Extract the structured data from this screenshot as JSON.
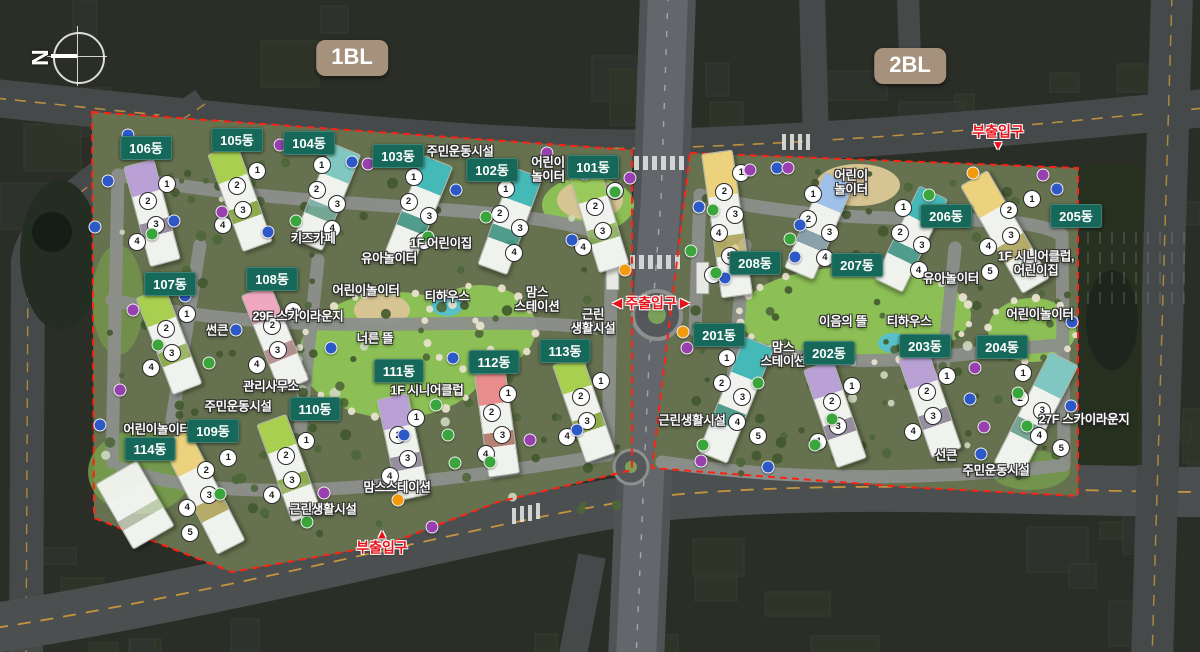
{
  "map": {
    "compass": {
      "letter": "N",
      "x": 77,
      "y": 56
    },
    "badges": [
      {
        "text": "1BL",
        "x": 352,
        "y": 58
      },
      {
        "text": "2BL",
        "x": 910,
        "y": 66
      }
    ],
    "entrances": [
      {
        "text": "주출입구",
        "x": 651,
        "y": 303,
        "style": "main"
      },
      {
        "text": "부출입구",
        "x": 998,
        "y": 138,
        "style": "sub-down"
      },
      {
        "text": "부출입구",
        "x": 382,
        "y": 541,
        "style": "sub-up"
      }
    ],
    "colors": {
      "building_pill": "#16695a",
      "bl_badge": "#a5917c",
      "entrance_red": "#e8111a",
      "boundary_red": "#ff2213",
      "site_green": "#647253",
      "park_green": "#8cbf56",
      "marker_blue": "#2d59c8",
      "marker_purple": "#9840b0",
      "marker_green": "#3aa53a",
      "marker_orange": "#f29a0c"
    },
    "buildings": [
      {
        "name": "101동",
        "label": [
          593,
          167
        ],
        "center": [
          599,
          219
        ],
        "tilt": -17,
        "units": 4,
        "accent": "#9acb5a"
      },
      {
        "name": "102동",
        "label": [
          492,
          170
        ],
        "center": [
          510,
          221
        ],
        "tilt": 20,
        "units": 4,
        "accent": "#45b8b8"
      },
      {
        "name": "103동",
        "label": [
          398,
          156
        ],
        "center": [
          419,
          209
        ],
        "tilt": 22,
        "units": 4,
        "accent": "#45b8b8"
      },
      {
        "name": "104동",
        "label": [
          309,
          143
        ],
        "center": [
          327,
          197
        ],
        "tilt": 22,
        "units": 4,
        "accent": "#7fc7c0"
      },
      {
        "name": "105동",
        "label": [
          237,
          140
        ],
        "center": [
          240,
          198
        ],
        "tilt": -20,
        "units": 4,
        "accent": "#a8cf4f"
      },
      {
        "name": "106동",
        "label": [
          146,
          148
        ],
        "center": [
          152,
          213
        ],
        "tilt": -15,
        "units": 4,
        "accent": "#b9a1d6"
      },
      {
        "name": "107동",
        "label": [
          170,
          284
        ],
        "center": [
          169,
          341
        ],
        "tilt": -21,
        "units": 4,
        "accent": "#a8cf4f"
      },
      {
        "name": "108동",
        "label": [
          272,
          279
        ],
        "center": [
          275,
          338
        ],
        "tilt": -22,
        "units": 4,
        "accent": "#f0a8c0"
      },
      {
        "name": "109동",
        "label": [
          213,
          431
        ],
        "center": [
          203,
          492
        ],
        "tilt": -27,
        "units": 5,
        "accent": "#ecd27c"
      },
      {
        "name": "110동",
        "label": [
          315,
          409
        ],
        "center": [
          289,
          468
        ],
        "tilt": -20,
        "units": 4,
        "accent": "#a8cf4f"
      },
      {
        "name": "111동",
        "label": [
          399,
          371
        ],
        "center": [
          403,
          447
        ],
        "tilt": -12,
        "units": 4,
        "accent": "#b9a1d6"
      },
      {
        "name": "112동",
        "label": [
          494,
          362
        ],
        "center": [
          497,
          424
        ],
        "tilt": -8,
        "units": 4,
        "accent": "#e88c8c"
      },
      {
        "name": "113동",
        "label": [
          565,
          351
        ],
        "center": [
          584,
          409
        ],
        "tilt": -19,
        "units": 4,
        "accent": "#a8cf4f"
      },
      {
        "name": "114동",
        "label": [
          150,
          449
        ],
        "center": [
          135,
          505
        ],
        "tilt": -30,
        "units": 0,
        "accent": "#eef0ea"
      },
      {
        "name": "201동",
        "label": [
          719,
          335
        ],
        "center": [
          736,
          400
        ],
        "tilt": 22,
        "units": 5,
        "accent": "#45b8b8"
      },
      {
        "name": "202동",
        "label": [
          829,
          353
        ],
        "center": [
          835,
          414
        ],
        "tilt": -19,
        "units": 4,
        "accent": "#b9a1d6"
      },
      {
        "name": "203동",
        "label": [
          925,
          346
        ],
        "center": [
          930,
          404
        ],
        "tilt": -19,
        "units": 4,
        "accent": "#b9a1d6"
      },
      {
        "name": "204동",
        "label": [
          1002,
          347
        ],
        "center": [
          1036,
          414
        ],
        "tilt": 27,
        "units": 5,
        "accent": "#7fc7c0"
      },
      {
        "name": "205동",
        "label": [
          1076,
          216
        ],
        "center": [
          1005,
          232
        ],
        "tilt": -30,
        "units": 5,
        "accent": "#ecd27c"
      },
      {
        "name": "206동",
        "label": [
          946,
          216
        ],
        "center": [
          911,
          239
        ],
        "tilt": 26,
        "units": 4,
        "accent": "#45b8b8"
      },
      {
        "name": "207동",
        "label": [
          857,
          265
        ],
        "center": [
          819,
          226
        ],
        "tilt": 23,
        "units": 4,
        "accent": "#9fc0e8"
      },
      {
        "name": "208동",
        "label": [
          755,
          263
        ],
        "center": [
          727,
          224
        ],
        "tilt": -8,
        "units": 6,
        "accent": "#ecd27c"
      }
    ],
    "facilities": [
      {
        "text": "주민운동시설",
        "x": 460,
        "y": 152
      },
      {
        "text": "어린이\n놀이터",
        "x": 548,
        "y": 170
      },
      {
        "text": "키즈카페",
        "x": 313,
        "y": 239
      },
      {
        "text": "유아놀이터",
        "x": 389,
        "y": 259
      },
      {
        "text": "1F 어린이집",
        "x": 441,
        "y": 244
      },
      {
        "text": "어린이놀이터",
        "x": 366,
        "y": 291
      },
      {
        "text": "29F 스카이라운지",
        "x": 298,
        "y": 317
      },
      {
        "text": "썬큰",
        "x": 217,
        "y": 331
      },
      {
        "text": "관리사무소",
        "x": 271,
        "y": 387
      },
      {
        "text": "주민운동시설",
        "x": 238,
        "y": 407
      },
      {
        "text": "너른 뜰",
        "x": 375,
        "y": 339
      },
      {
        "text": "티하우스",
        "x": 447,
        "y": 297
      },
      {
        "text": "맘스\n스테이션",
        "x": 537,
        "y": 300
      },
      {
        "text": "근린\n생활시설",
        "x": 593,
        "y": 322
      },
      {
        "text": "1F 시니어클럽",
        "x": 427,
        "y": 391
      },
      {
        "text": "어린이놀이터",
        "x": 157,
        "y": 430
      },
      {
        "text": "맘스스테이션",
        "x": 397,
        "y": 488
      },
      {
        "text": "근린생활시설",
        "x": 323,
        "y": 510
      },
      {
        "text": "어린이\n놀이터",
        "x": 851,
        "y": 183
      },
      {
        "text": "유아놀이터",
        "x": 951,
        "y": 279
      },
      {
        "text": "1F 시니어클럽,\n어린이집",
        "x": 1036,
        "y": 264
      },
      {
        "text": "이음의 뜰",
        "x": 843,
        "y": 322
      },
      {
        "text": "티하우스",
        "x": 909,
        "y": 322
      },
      {
        "text": "맘스\n스테이션",
        "x": 783,
        "y": 355
      },
      {
        "text": "어린이놀이터",
        "x": 1040,
        "y": 315
      },
      {
        "text": "27F 스카이라운지",
        "x": 1084,
        "y": 420
      },
      {
        "text": "선큰",
        "x": 946,
        "y": 456
      },
      {
        "text": "주민운동시설",
        "x": 996,
        "y": 471
      },
      {
        "text": "근린생활시설",
        "x": 692,
        "y": 421
      }
    ],
    "markers": [
      [
        128,
        135,
        "b"
      ],
      [
        280,
        145,
        "p"
      ],
      [
        352,
        162,
        "b"
      ],
      [
        368,
        164,
        "p"
      ],
      [
        547,
        153,
        "p"
      ],
      [
        585,
        174,
        "b"
      ],
      [
        630,
        178,
        "p"
      ],
      [
        615,
        192,
        "g"
      ],
      [
        456,
        190,
        "b"
      ],
      [
        486,
        217,
        "g"
      ],
      [
        428,
        237,
        "g"
      ],
      [
        296,
        221,
        "g"
      ],
      [
        268,
        232,
        "b"
      ],
      [
        222,
        212,
        "p"
      ],
      [
        174,
        221,
        "b"
      ],
      [
        152,
        234,
        "g"
      ],
      [
        108,
        181,
        "b"
      ],
      [
        95,
        227,
        "b"
      ],
      [
        572,
        240,
        "b"
      ],
      [
        133,
        310,
        "p"
      ],
      [
        185,
        296,
        "b"
      ],
      [
        236,
        330,
        "b"
      ],
      [
        158,
        345,
        "g"
      ],
      [
        209,
        363,
        "g"
      ],
      [
        331,
        348,
        "b"
      ],
      [
        453,
        358,
        "b"
      ],
      [
        436,
        405,
        "g"
      ],
      [
        448,
        435,
        "g"
      ],
      [
        490,
        462,
        "g"
      ],
      [
        432,
        527,
        "p"
      ],
      [
        404,
        435,
        "b"
      ],
      [
        530,
        440,
        "p"
      ],
      [
        577,
        430,
        "b"
      ],
      [
        120,
        390,
        "p"
      ],
      [
        100,
        425,
        "b"
      ],
      [
        220,
        494,
        "g"
      ],
      [
        324,
        493,
        "p"
      ],
      [
        307,
        522,
        "g"
      ],
      [
        398,
        500,
        "o"
      ],
      [
        455,
        463,
        "g"
      ],
      [
        625,
        270,
        "o"
      ],
      [
        683,
        332,
        "o"
      ],
      [
        750,
        170,
        "p"
      ],
      [
        777,
        168,
        "b"
      ],
      [
        788,
        168,
        "p"
      ],
      [
        973,
        173,
        "o"
      ],
      [
        1043,
        175,
        "p"
      ],
      [
        1057,
        189,
        "b"
      ],
      [
        929,
        195,
        "g"
      ],
      [
        699,
        207,
        "b"
      ],
      [
        713,
        210,
        "g"
      ],
      [
        800,
        225,
        "b"
      ],
      [
        790,
        239,
        "g"
      ],
      [
        795,
        257,
        "b"
      ],
      [
        725,
        278,
        "b"
      ],
      [
        716,
        273,
        "g"
      ],
      [
        691,
        251,
        "g"
      ],
      [
        687,
        348,
        "p"
      ],
      [
        758,
        383,
        "g"
      ],
      [
        832,
        419,
        "g"
      ],
      [
        815,
        445,
        "g"
      ],
      [
        703,
        445,
        "g"
      ],
      [
        701,
        461,
        "p"
      ],
      [
        768,
        467,
        "b"
      ],
      [
        1072,
        322,
        "b"
      ],
      [
        975,
        368,
        "p"
      ],
      [
        970,
        399,
        "b"
      ],
      [
        1018,
        393,
        "g"
      ],
      [
        984,
        427,
        "p"
      ],
      [
        1027,
        426,
        "g"
      ],
      [
        981,
        454,
        "b"
      ],
      [
        1071,
        406,
        "b"
      ]
    ]
  }
}
